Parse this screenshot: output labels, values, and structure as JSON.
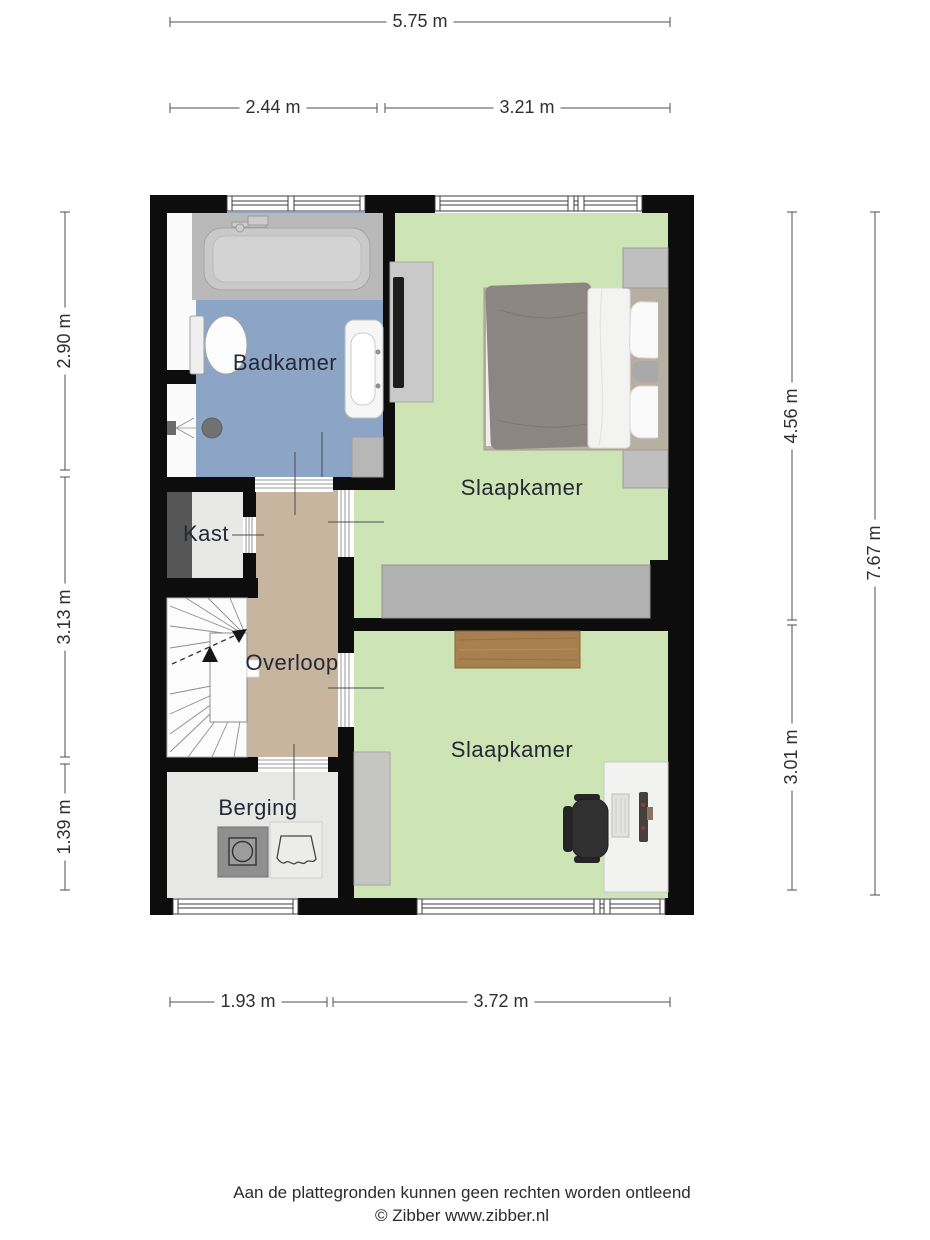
{
  "plan": {
    "title_type": "floorplan-first-floor",
    "rooms": [
      {
        "id": "badkamer",
        "label": "Badkamer"
      },
      {
        "id": "slaapkamer_top",
        "label": "Slaapkamer"
      },
      {
        "id": "kast",
        "label": "Kast"
      },
      {
        "id": "overloop",
        "label": "Overloop"
      },
      {
        "id": "slaapkamer_bottom",
        "label": "Slaapkamer"
      },
      {
        "id": "berging",
        "label": "Berging"
      }
    ],
    "colors": {
      "wall": "#0d0d0d",
      "bathroom_floor": "#8ca4c6",
      "bedroom_floor": "#cde4b4",
      "landing_floor": "#c8b5a0",
      "storage_floor": "#e7e7e5",
      "stairs": "#fcfcfc",
      "bathtub_gray": "#b9b9b9",
      "wood": "#a87f4e"
    },
    "icons": {
      "washing_machine": "square-with-drum-circle",
      "laundry_basket": "basket-outline",
      "shower": "shower-head-with-spray",
      "stairs_direction": "dashed-walkline-arrows"
    }
  },
  "dimensions": {
    "top_total": "5.75 m",
    "top_segments": [
      "2.44 m",
      "3.21 m"
    ],
    "left_segments": [
      "2.90 m",
      "3.13 m",
      "1.39 m"
    ],
    "right_segments": [
      "4.56 m",
      "3.01 m"
    ],
    "right_total": "7.67 m",
    "bottom_segments": [
      "1.93 m",
      "3.72 m"
    ]
  },
  "footer": {
    "disclaimer": "Aan de plattegronden kunnen geen rechten worden ontleend",
    "copyright": "© Zibber www.zibber.nl"
  }
}
